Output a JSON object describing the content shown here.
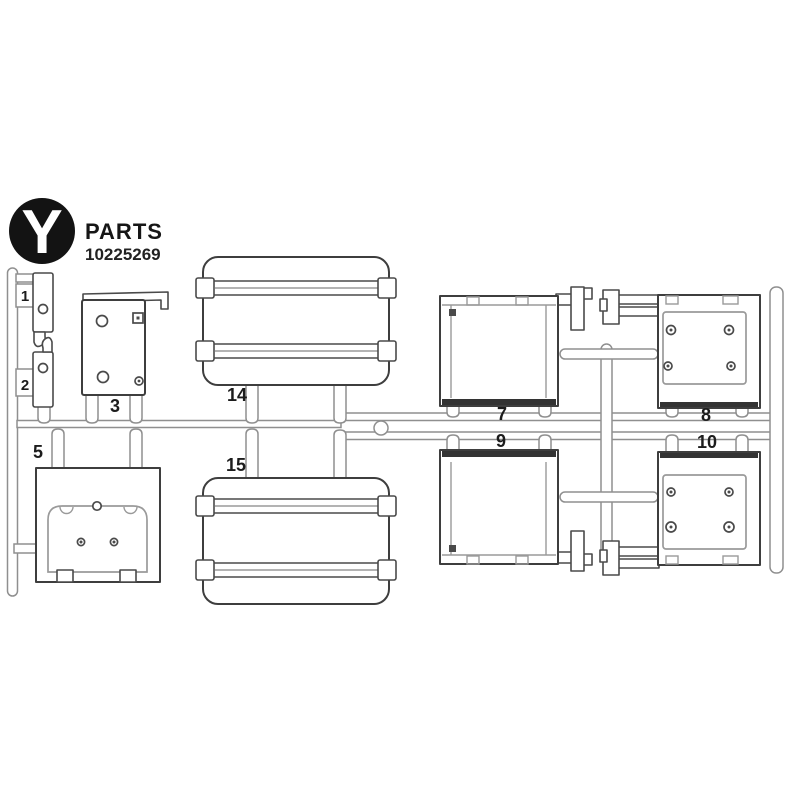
{
  "header": {
    "logo_letter": "Y",
    "title": "PARTS",
    "part_number": "10225269"
  },
  "labels": {
    "p1": "1",
    "p2": "2",
    "p3": "3",
    "p5": "5",
    "p7": "7",
    "p8": "8",
    "p9": "9",
    "p10": "10",
    "p14": "14",
    "p15": "15"
  },
  "colors": {
    "ink": "#1c1c1c",
    "part_outline": "#3e3e3e",
    "runner_line": "#8f8f8f",
    "background": "#ffffff"
  }
}
